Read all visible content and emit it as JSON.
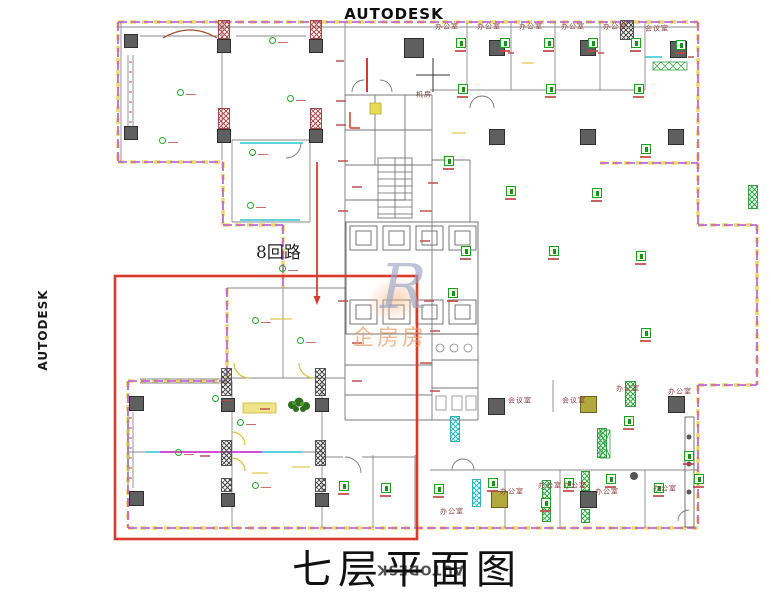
{
  "watermarks": {
    "top": "AUTODESK",
    "left": "AUTODESK",
    "bottom": "AUTODESK"
  },
  "logo_watermark": {
    "letter": "R",
    "text": "企房房",
    "color": "#e89a66"
  },
  "title": {
    "text": "七层平面图"
  },
  "annotations": {
    "circuit_label": "8回路"
  },
  "highlight": {
    "x": 115,
    "y": 276,
    "w": 302,
    "h": 263,
    "color": "#d93a2b"
  },
  "palette": {
    "wall_magenta": "#c368cc",
    "wall_yellow": "#ecd86a",
    "cyan": "#2cc5d4",
    "symbol_green": "#17a517",
    "code_red": "#c04848",
    "column_gray": "#5f5f5f"
  },
  "plan": {
    "room_labels": [
      {
        "t": "办公室",
        "x": 447,
        "y": 27
      },
      {
        "t": "办公室",
        "x": 489,
        "y": 27
      },
      {
        "t": "办公室",
        "x": 531,
        "y": 27
      },
      {
        "t": "办公室",
        "x": 573,
        "y": 27
      },
      {
        "t": "办公室",
        "x": 615,
        "y": 27
      },
      {
        "t": "会议室",
        "x": 657,
        "y": 29
      },
      {
        "t": "会议室",
        "x": 520,
        "y": 401
      },
      {
        "t": "会议室",
        "x": 574,
        "y": 401
      },
      {
        "t": "办公室",
        "x": 628,
        "y": 389
      },
      {
        "t": "办公室",
        "x": 680,
        "y": 392
      },
      {
        "t": "办公室",
        "x": 452,
        "y": 512
      },
      {
        "t": "办公室",
        "x": 512,
        "y": 492
      },
      {
        "t": "办公室",
        "x": 550,
        "y": 486
      },
      {
        "t": "办公室",
        "x": 575,
        "y": 486
      },
      {
        "t": "办公室",
        "x": 607,
        "y": 492
      },
      {
        "t": "办公室",
        "x": 665,
        "y": 489
      },
      {
        "t": "机房",
        "x": 424,
        "y": 95
      }
    ],
    "columns_gray": [
      [
        124,
        34,
        14,
        14
      ],
      [
        124,
        126,
        14,
        14
      ],
      [
        217,
        39,
        14,
        14
      ],
      [
        217,
        129,
        14,
        14
      ],
      [
        309,
        39,
        14,
        14
      ],
      [
        309,
        129,
        14,
        14
      ],
      [
        404,
        38,
        20,
        20
      ],
      [
        489,
        40,
        16,
        16
      ],
      [
        580,
        40,
        16,
        16
      ],
      [
        670,
        41,
        17,
        17
      ],
      [
        489,
        129,
        16,
        16
      ],
      [
        580,
        129,
        16,
        16
      ],
      [
        668,
        129,
        16,
        16
      ],
      [
        488,
        398,
        17,
        17
      ],
      [
        668,
        396,
        17,
        17
      ],
      [
        129,
        396,
        15,
        15
      ],
      [
        129,
        491,
        15,
        15
      ],
      [
        221,
        398,
        14,
        14
      ],
      [
        315,
        398,
        14,
        14
      ],
      [
        221,
        493,
        14,
        14
      ],
      [
        315,
        493,
        14,
        14
      ],
      [
        580,
        491,
        17,
        17
      ]
    ],
    "columns_olive": [
      [
        580,
        396,
        17,
        17
      ],
      [
        491,
        491,
        17,
        17
      ]
    ],
    "hatch_red": [
      [
        218,
        20,
        12,
        19
      ],
      [
        310,
        20,
        12,
        19
      ],
      [
        218,
        108,
        12,
        21
      ],
      [
        310,
        108,
        12,
        21
      ]
    ],
    "hatch_black": [
      [
        620,
        20,
        14,
        20
      ],
      [
        221,
        368,
        11,
        28
      ],
      [
        221,
        440,
        11,
        26
      ],
      [
        221,
        478,
        11,
        14
      ],
      [
        315,
        368,
        11,
        28
      ],
      [
        315,
        440,
        11,
        26
      ],
      [
        315,
        478,
        11,
        14
      ]
    ],
    "hatch_green": [
      [
        542,
        480,
        9,
        42
      ],
      [
        581,
        471,
        9,
        20
      ],
      [
        581,
        509,
        9,
        14
      ],
      [
        625,
        381,
        11,
        26
      ],
      [
        748,
        185,
        10,
        24
      ],
      [
        597,
        428,
        10,
        30
      ]
    ],
    "hatch_cyan": [
      [
        472,
        479,
        9,
        28
      ],
      [
        450,
        416,
        10,
        26
      ]
    ],
    "panels": [
      [
        456,
        38
      ],
      [
        500,
        38
      ],
      [
        544,
        38
      ],
      [
        588,
        38
      ],
      [
        631,
        38
      ],
      [
        676,
        40
      ],
      [
        458,
        84
      ],
      [
        546,
        84
      ],
      [
        634,
        84
      ],
      [
        641,
        144
      ],
      [
        506,
        186
      ],
      [
        592,
        188
      ],
      [
        636,
        251
      ],
      [
        461,
        246
      ],
      [
        549,
        246
      ],
      [
        641,
        328
      ],
      [
        624,
        416
      ],
      [
        684,
        451
      ],
      [
        488,
        478
      ],
      [
        564,
        478
      ],
      [
        606,
        474
      ],
      [
        654,
        483
      ],
      [
        694,
        474
      ],
      [
        541,
        498
      ],
      [
        434,
        484
      ],
      [
        339,
        481
      ],
      [
        381,
        483
      ],
      [
        444,
        156
      ],
      [
        448,
        288
      ]
    ],
    "lights": [
      [
        180,
        92
      ],
      [
        162,
        140
      ],
      [
        272,
        40
      ],
      [
        290,
        98
      ],
      [
        252,
        152
      ],
      [
        250,
        205
      ],
      [
        282,
        268
      ],
      [
        215,
        398
      ],
      [
        178,
        452
      ],
      [
        240,
        422
      ],
      [
        255,
        485
      ],
      [
        300,
        340
      ],
      [
        255,
        320
      ]
    ],
    "yellow_marks": [
      [
        270,
        318,
        22
      ],
      [
        292,
        466,
        18
      ],
      [
        252,
        472,
        16
      ],
      [
        452,
        132,
        14
      ],
      [
        522,
        62,
        12
      ]
    ],
    "red_marks": [
      [
        336,
        100,
        10
      ],
      [
        336,
        124,
        10
      ],
      [
        428,
        182,
        10
      ],
      [
        420,
        210,
        12
      ],
      [
        338,
        160,
        10
      ],
      [
        352,
        186,
        10
      ],
      [
        420,
        240,
        10
      ],
      [
        338,
        210,
        10
      ],
      [
        424,
        300,
        10
      ],
      [
        338,
        300,
        10
      ],
      [
        430,
        330,
        10
      ],
      [
        352,
        342,
        10
      ],
      [
        420,
        362,
        12
      ],
      [
        352,
        380,
        10
      ],
      [
        430,
        390,
        10
      ],
      [
        336,
        60,
        8
      ],
      [
        508,
        52,
        6
      ],
      [
        598,
        52,
        6
      ],
      [
        688,
        56,
        6
      ],
      [
        260,
        408,
        10
      ],
      [
        200,
        455,
        10
      ]
    ]
  }
}
